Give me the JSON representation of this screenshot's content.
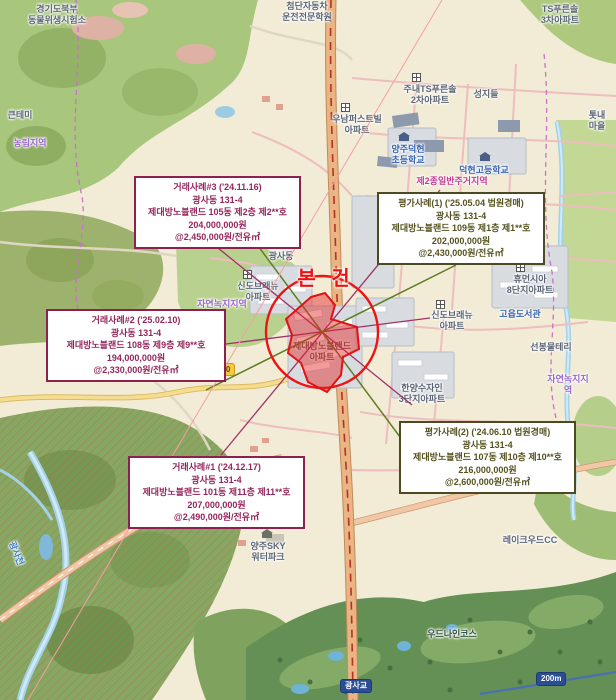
{
  "subject": {
    "label": "본 건"
  },
  "callouts": {
    "sale1": {
      "title": "거래사례#1 ('24.12.17)",
      "address": "광사동 131-4",
      "unit": "제대방노블랜드 101동 제11층 제11**호",
      "price": "207,000,000원",
      "unit_price": "@2,490,000원/전유㎡"
    },
    "sale2": {
      "title": "거래사례#2 ('25.02.10)",
      "address": "광사동 131-4",
      "unit": "제대방노블랜드 108동 제9층 제9**호",
      "price": "194,000,000원",
      "unit_price": "@2,330,000원/전유㎡"
    },
    "sale3": {
      "title": "거래사례#3 ('24.11.16)",
      "address": "광사동 131-4",
      "unit": "제대방노블랜드 105동 제2층 제2**호",
      "price": "204,000,000원",
      "unit_price": "@2,450,000원/전유㎡"
    },
    "appraisal1": {
      "title": "평가사례(1) ('25.05.04 법원경매)",
      "address": "광사동 131-4",
      "unit": "제대방노블랜드 109동 제1층 제1**호",
      "price": "202,000,000원",
      "unit_price": "@2,430,000원/전유㎡"
    },
    "appraisal2": {
      "title": "평가사례(2) ('24.06.10 법원경매)",
      "address": "광사동 131-4",
      "unit": "제대방노블랜드 107동 제10층 제10**호",
      "price": "216,000,000원",
      "unit_price": "@2,600,000원/전유㎡"
    }
  },
  "map_labels": {
    "gov_lab": "경기도북부\n동물위생시험소",
    "driving_school": "첨단자동차\n운전전문학원",
    "ts3_apt": "TS푸른솔\n3차아파트",
    "ts2_apt": "주내TS푸른솔\n2차아파트",
    "seongjideul": "성지들",
    "unam_apt": "우남퍼스트빌\n아파트",
    "keuntemi": "큰테미",
    "totnae": "톳내마을",
    "nonglim_zone": "농림지역",
    "elem_school": "양주덕현\n초등학교",
    "high_school": "덕현고등학교",
    "zone2_label": "제2종일반주거지역",
    "gwangsadong": "광사동",
    "sindo_west": "신도브래뉴\n아파트",
    "sindo_east": "신도브래뉴\n아파트",
    "apt_right": "아파트",
    "humansia": "휴먼시아\n8단지아파트",
    "goeup_library": "고읍도서관",
    "seonbong": "선봉물테리",
    "nokji_right": "자연녹지지역",
    "nokji_center": "자연녹지지역",
    "hanyang": "한양수자인\n3단지아파트",
    "subject_apt": "제대방노블랜드\n아파트",
    "waterpark": "양주SKY\n워터파크",
    "lakewood_cc": "레이크우드CC",
    "woodnine": "우드나인코스",
    "gwangsacheon": "광사천"
  },
  "badges": {
    "route": "350",
    "bridge": "광사교",
    "scale": "200m"
  },
  "colors": {
    "sale_accent": "#8c2150",
    "appraisal_accent": "#4c4a22",
    "subject_red": "#e81515"
  }
}
